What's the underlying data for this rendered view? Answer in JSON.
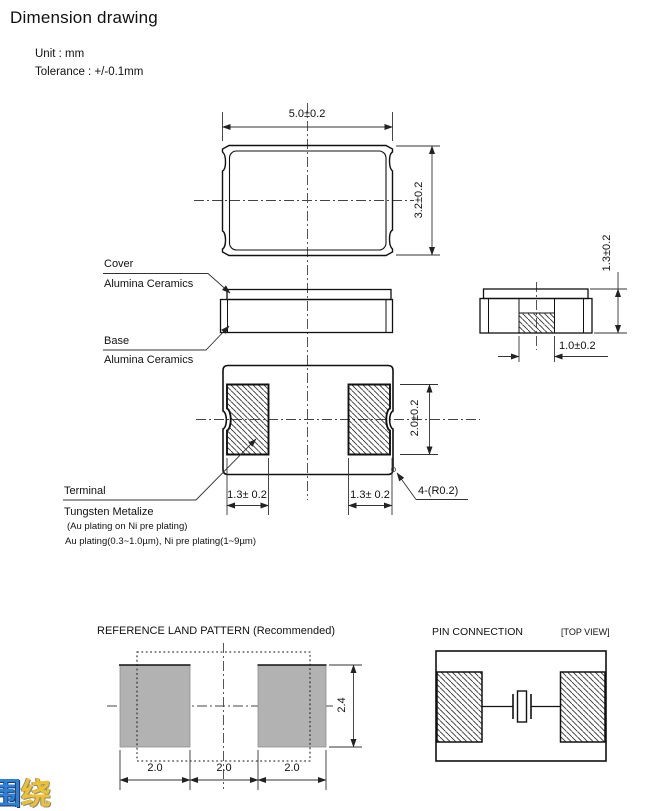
{
  "header": {
    "title": "Dimension drawing",
    "unit": "Unit : mm",
    "tolerance": "Tolerance : +/-0.1mm"
  },
  "top_view": {
    "dim_width": "5.0±0.2",
    "dim_height": "3.2±0.2"
  },
  "side_view": {
    "label_cover": "Cover",
    "label_cover_material": "Alumina Ceramics",
    "label_base": "Base",
    "label_base_material": "Alumina Ceramics"
  },
  "end_view": {
    "dim_height": "1.3±0.2",
    "dim_terminal_width": "1.0±0.2"
  },
  "bottom_view": {
    "dim_pad_height": "2.0±0.2",
    "dim_pad_width_left": "1.3± 0.2",
    "dim_pad_width_right": "1.3± 0.2",
    "corner_radius_note": "4-(R0.2)"
  },
  "terminal_notes": {
    "label_terminal": "Terminal",
    "label_metalize": "Tungsten Metalize",
    "plating_note_1": "(Au plating on Ni pre plating)",
    "plating_note_2": "Au plating(0.3~1.0µm), Ni pre plating(1~9µm)"
  },
  "land_pattern": {
    "title": "REFERENCE LAND PATTERN (Recommended)",
    "dim_height": "2.4",
    "dim_span_1": "2.0",
    "dim_span_2": "2.0",
    "dim_span_3": "2.0"
  },
  "pin_connection": {
    "title": "PIN CONNECTION",
    "view_tag": "[TOP VIEW]"
  },
  "watermark": {
    "char_1": "围",
    "char_2": "绕"
  },
  "colors": {
    "line": "#1a1a1a",
    "dimension_line": "#333333",
    "land_pad_gray": "#b2b2b2",
    "watermark_blue": "#2e7fd6",
    "watermark_yellow": "#f0c229"
  }
}
